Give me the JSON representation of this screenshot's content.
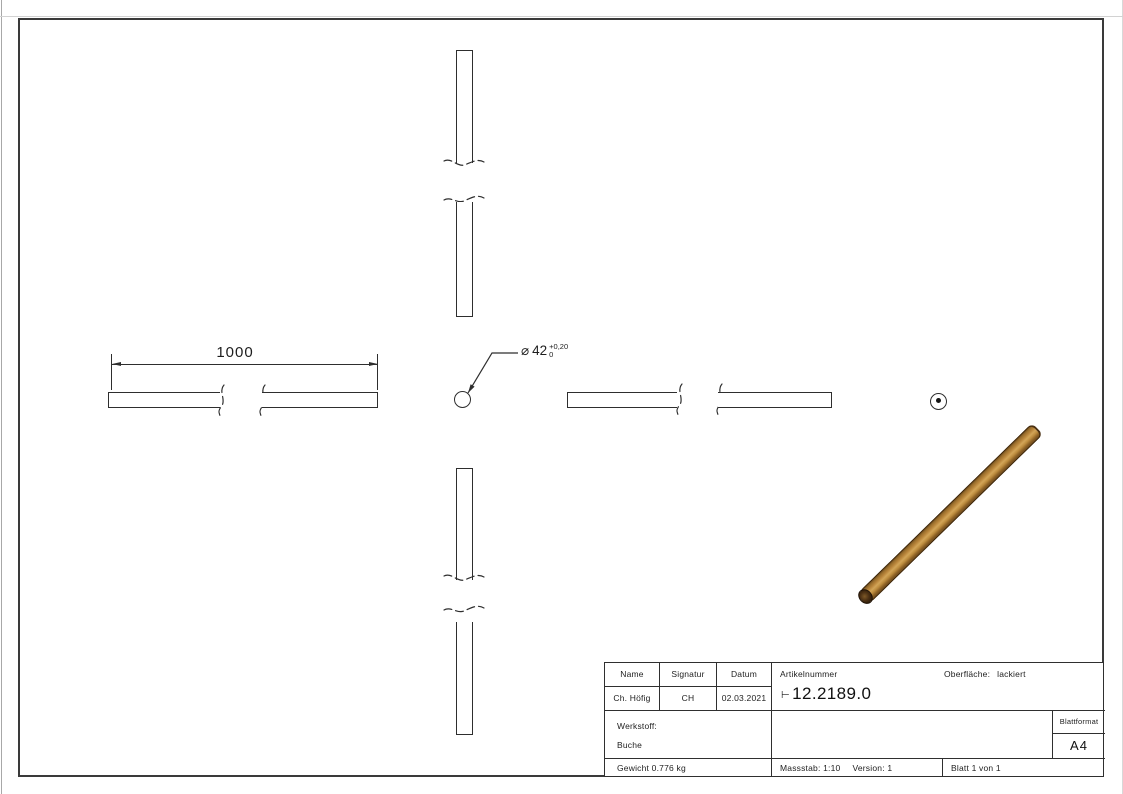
{
  "views": {
    "length_dimension": "1000",
    "diameter_callout": {
      "symbol": "⌀",
      "value": "42",
      "tol_upper": "+0,20",
      "tol_lower": "0"
    }
  },
  "title_block": {
    "name_header": "Name",
    "signatur_header": "Signatur",
    "datum_header": "Datum",
    "artikelnummer_header": "Artikelnummer",
    "oberflaeche_label": "Oberfläche:",
    "oberflaeche_value": "lackiert",
    "name_value": "Ch. Höfig",
    "signatur_value": "CH",
    "datum_value": "02.03.2021",
    "artikelnummer_prefix": "⊢",
    "artikelnummer_value": "12.2189.0",
    "werkstoff_label": "Werkstoff:",
    "werkstoff_value": "Buche",
    "blattformat_label": "Blattformat",
    "blattformat_value": "A4",
    "gewicht": "Gewicht 0.776 kg",
    "massstab": "Massstab: 1:10",
    "version": "Version: 1",
    "blatt": "Blatt 1 von 1"
  },
  "colors": {
    "line": "#2e2e2e",
    "wood_highlight": "#d2a558",
    "wood_mid": "#b9853b",
    "wood_shadow": "#6f4b1d",
    "wood_end_face": "#4a2f13"
  }
}
